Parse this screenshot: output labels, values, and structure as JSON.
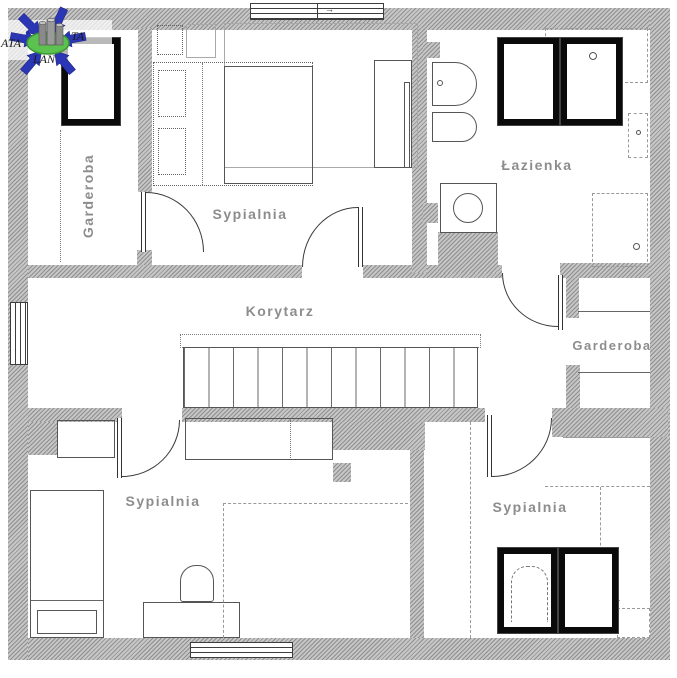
{
  "watermark": {
    "text_left": "ATA",
    "text_right": "TA",
    "text_bottom": "LAN"
  },
  "rooms": {
    "garderoba_top_left": "Garderoba",
    "sypialnia_top": "Sypialnia",
    "lazienka": "Łazienka",
    "korytarz": "Korytarz",
    "garderoba_right": "Garderoba",
    "sypialnia_bottom_left": "Sypialnia",
    "sypialnia_bottom_right": "Sypialnia"
  },
  "colors": {
    "background": "#ffffff",
    "wall_hatch_dark": "#8f8f8f",
    "wall_hatch_light": "#c6c6c6",
    "line": "#4a4a4a",
    "room_label": "#8d8d8d",
    "roof_window_frame": "#0a0a0a",
    "watermark_blue": "#2b36b5",
    "watermark_green": "#5cc24f"
  }
}
